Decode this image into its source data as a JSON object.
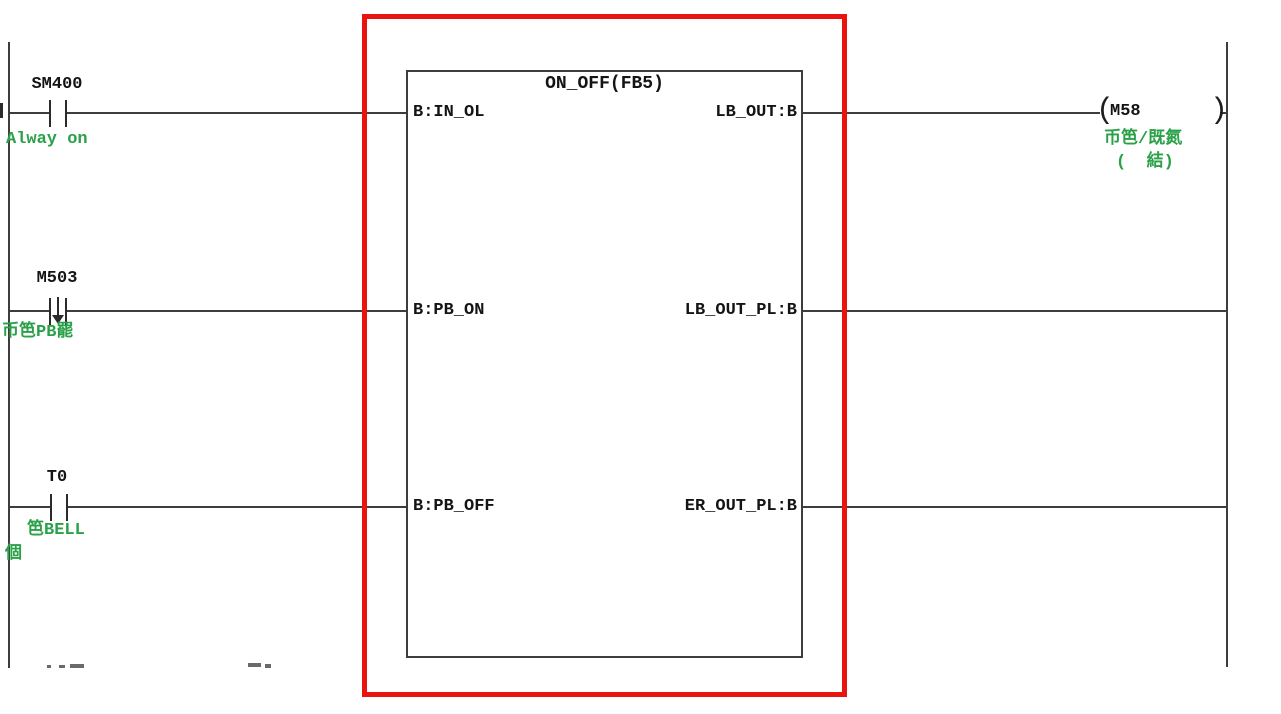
{
  "colors": {
    "line": "#3d3d3d",
    "comment_green": "#2aa148",
    "highlight_red": "#e9130f",
    "text": "#141414"
  },
  "rungs": {
    "rung1": {
      "device": "SM400",
      "contact_type": "normally-open",
      "comment": "Alway on"
    },
    "rung2": {
      "device": "M503",
      "contact_type": "falling-edge",
      "comment": "币笆PB罷"
    },
    "rung3": {
      "device": "T0",
      "contact_type": "normally-open",
      "comment": "笆BELL",
      "comment2": "個"
    }
  },
  "function_block": {
    "title": "ON_OFF(FB5)",
    "inputs": [
      "B:IN_OL",
      "B:PB_ON",
      "B:PB_OFF"
    ],
    "outputs": [
      "LB_OUT:B",
      "LB_OUT_PL:B",
      "ER_OUT_PL:B"
    ]
  },
  "coil": {
    "device": "M58",
    "paren_open": "(",
    "paren_close": ")",
    "comment_line1": "币笆/既氮",
    "comment_line2": "(  結)"
  }
}
